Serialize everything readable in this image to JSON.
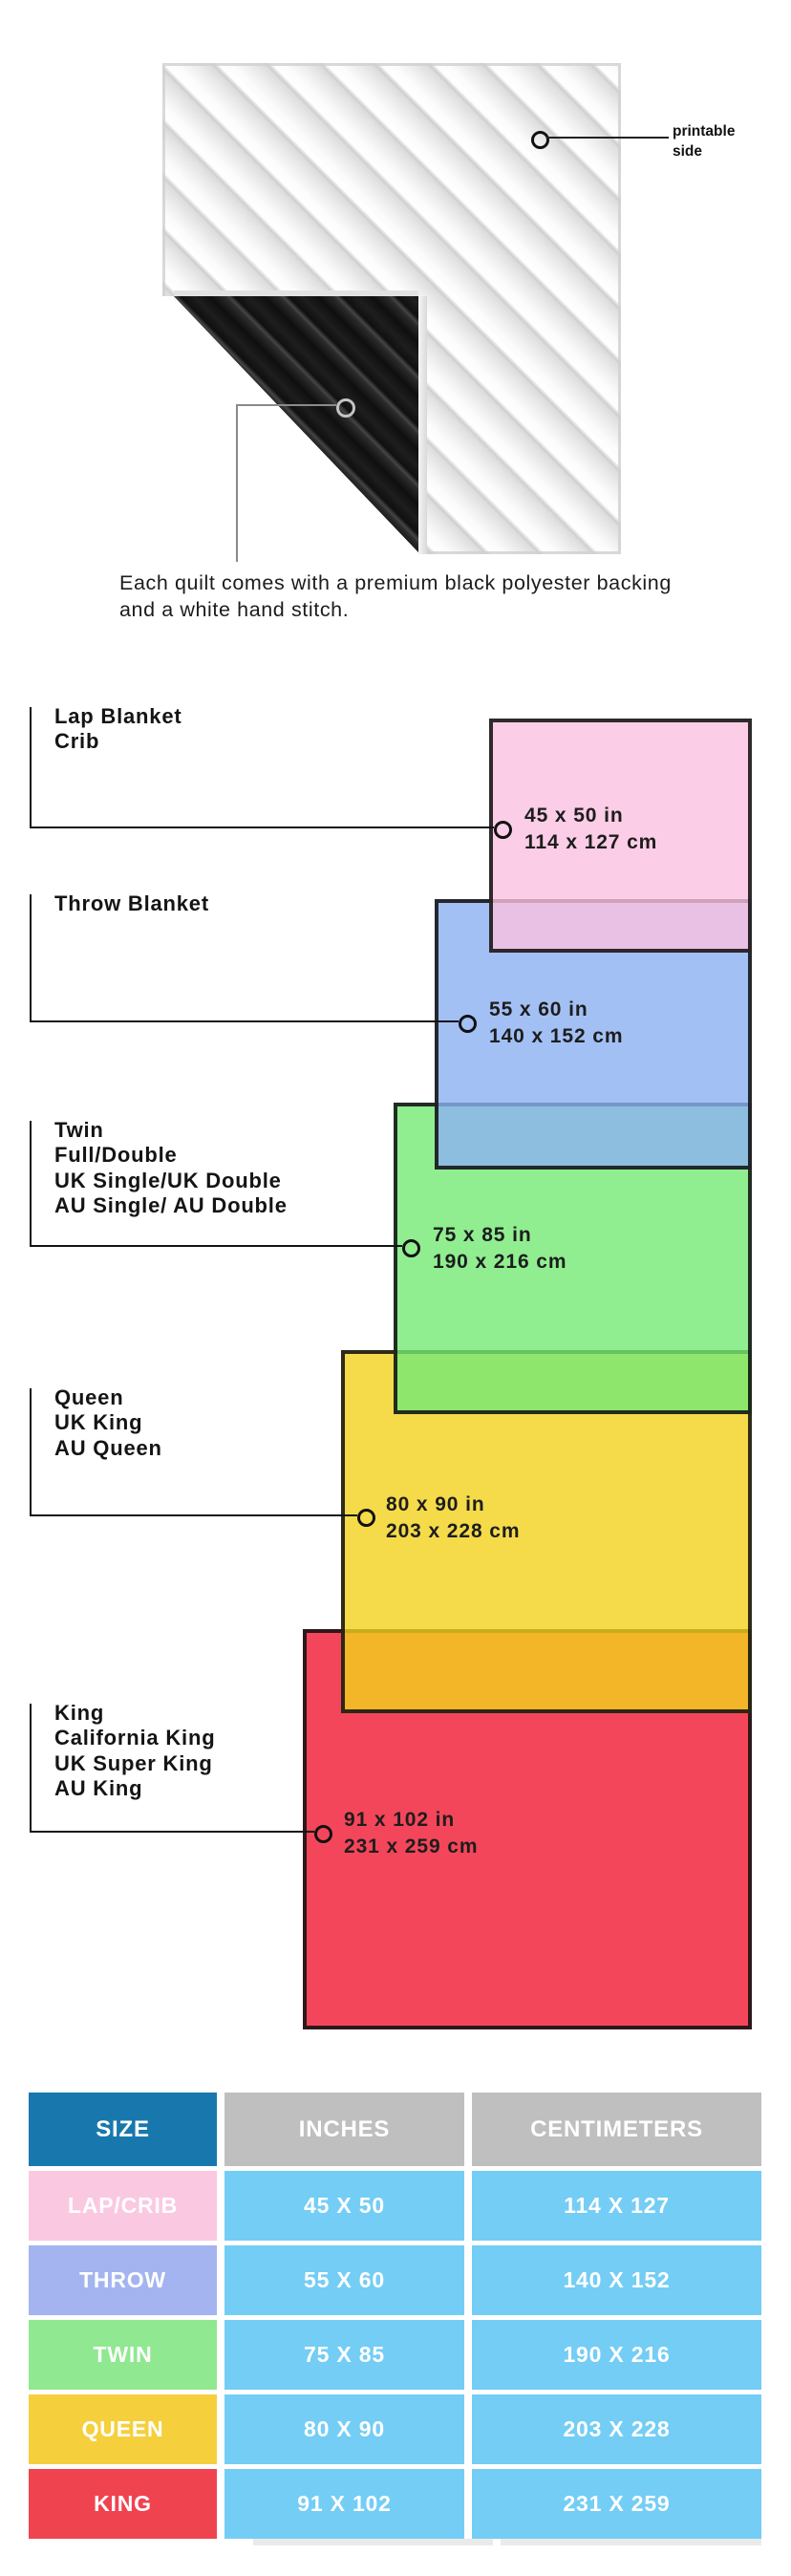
{
  "quilt": {
    "printable_label": "printable side",
    "backing_note": "Each quilt comes with a premium black polyester backing and a white hand stitch."
  },
  "diagram": {
    "sizes": [
      {
        "id": "lap",
        "label": "Lap Blanket\nCrib",
        "dims": "45 x 50 in\n114 x 127 cm",
        "fill": "rgba(250,193,224,0.8)"
      },
      {
        "id": "throw",
        "label": "Throw Blanket",
        "dims": "55 x 60 in\n140 x 152 cm",
        "fill": "rgba(140,176,243,0.8)"
      },
      {
        "id": "twin",
        "label": "Twin\nFull/Double\nUK Single/UK Double\nAU Single/ AU Double",
        "dims": "75 x 85 in\n190 x 216 cm",
        "fill": "rgba(116,234,116,0.8)"
      },
      {
        "id": "queen",
        "label": "Queen\nUK King\nAU Queen",
        "dims": "80 x 90 in\n203 x 228 cm",
        "fill": "rgba(243,210,29,0.8)"
      },
      {
        "id": "king",
        "label": "King\nCalifornia King\nUK Super King\nAU King",
        "dims": "91 x 102 in\n231 x 259 cm",
        "fill": "rgba(241,24,49,0.8)"
      }
    ]
  },
  "table": {
    "headers": [
      {
        "label": "SIZE",
        "bg": "#1878AD"
      },
      {
        "label": "INCHES",
        "bg": "#BFBFBF"
      },
      {
        "label": "CENTIMETERS",
        "bg": "#BFBFBF"
      }
    ],
    "value_bg": "#74CDF5",
    "rows": [
      {
        "size": "LAP/CRIB",
        "bg": "#FBC8E1",
        "inches": "45 X 50",
        "cm": "114 X 127"
      },
      {
        "size": "THROW",
        "bg": "#A3B4F0",
        "inches": "55 X 60",
        "cm": "140 X 152"
      },
      {
        "size": "TWIN",
        "bg": "#90E890",
        "inches": "75 X 85",
        "cm": "190 X 216"
      },
      {
        "size": "QUEEN",
        "bg": "#F5D03C",
        "inches": "80 X 90",
        "cm": "203 X 228"
      },
      {
        "size": "KING",
        "bg": "#F04350",
        "inches": "91 X 102",
        "cm": "231 X 259"
      }
    ]
  }
}
